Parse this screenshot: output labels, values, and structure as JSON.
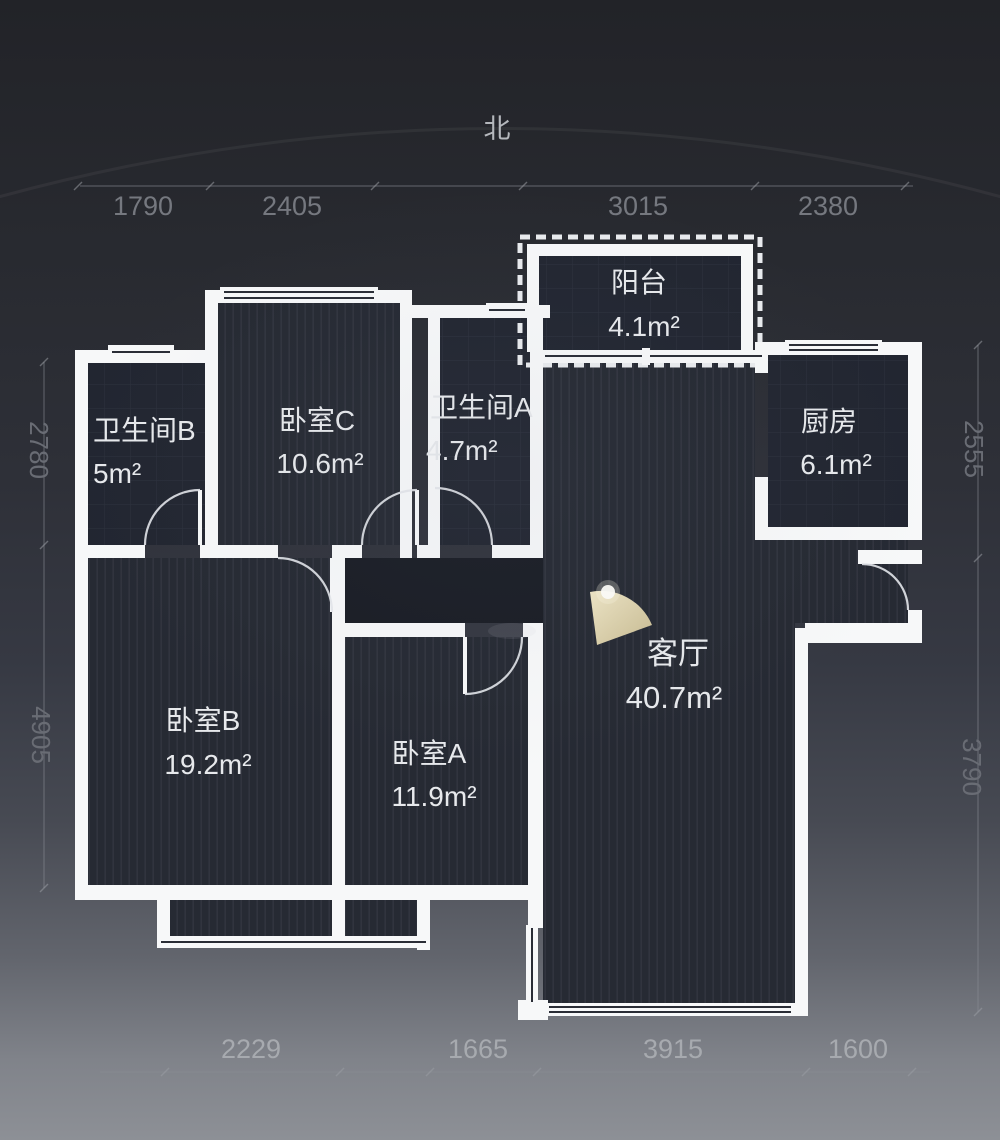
{
  "compass": {
    "north_label": "北"
  },
  "dimensions": {
    "top": [
      "1790",
      "2405",
      "3015",
      "2380"
    ],
    "bottom": [
      "2229",
      "1665",
      "3915",
      "1600"
    ],
    "left": [
      "2780",
      "4905"
    ],
    "right": [
      "2555",
      "3790"
    ]
  },
  "rooms": [
    {
      "id": "balcony",
      "name": "阳台",
      "area": "4.1m²"
    },
    {
      "id": "bathroom-b",
      "name": "卫生间B",
      "area": "5m²"
    },
    {
      "id": "bedroom-c",
      "name": "卧室C",
      "area": "10.6m²"
    },
    {
      "id": "bathroom-a",
      "name": "卫生间A",
      "area": "4.7m²"
    },
    {
      "id": "kitchen",
      "name": "厨房",
      "area": "6.1m²"
    },
    {
      "id": "living-room",
      "name": "客厅",
      "area": "40.7m²"
    },
    {
      "id": "bedroom-b",
      "name": "卧室B",
      "area": "19.2m²"
    },
    {
      "id": "bedroom-a",
      "name": "卧室A",
      "area": "11.9m²"
    }
  ],
  "colors": {
    "wall": "#f7f8f9",
    "floor": "#262a33",
    "corridor_floor": "#1a1d25",
    "lamp": "#d9cda8",
    "label_text": "#e7e9ec",
    "dim_text_dark": "#75787f",
    "dim_text_light": "#a7aaaf"
  }
}
